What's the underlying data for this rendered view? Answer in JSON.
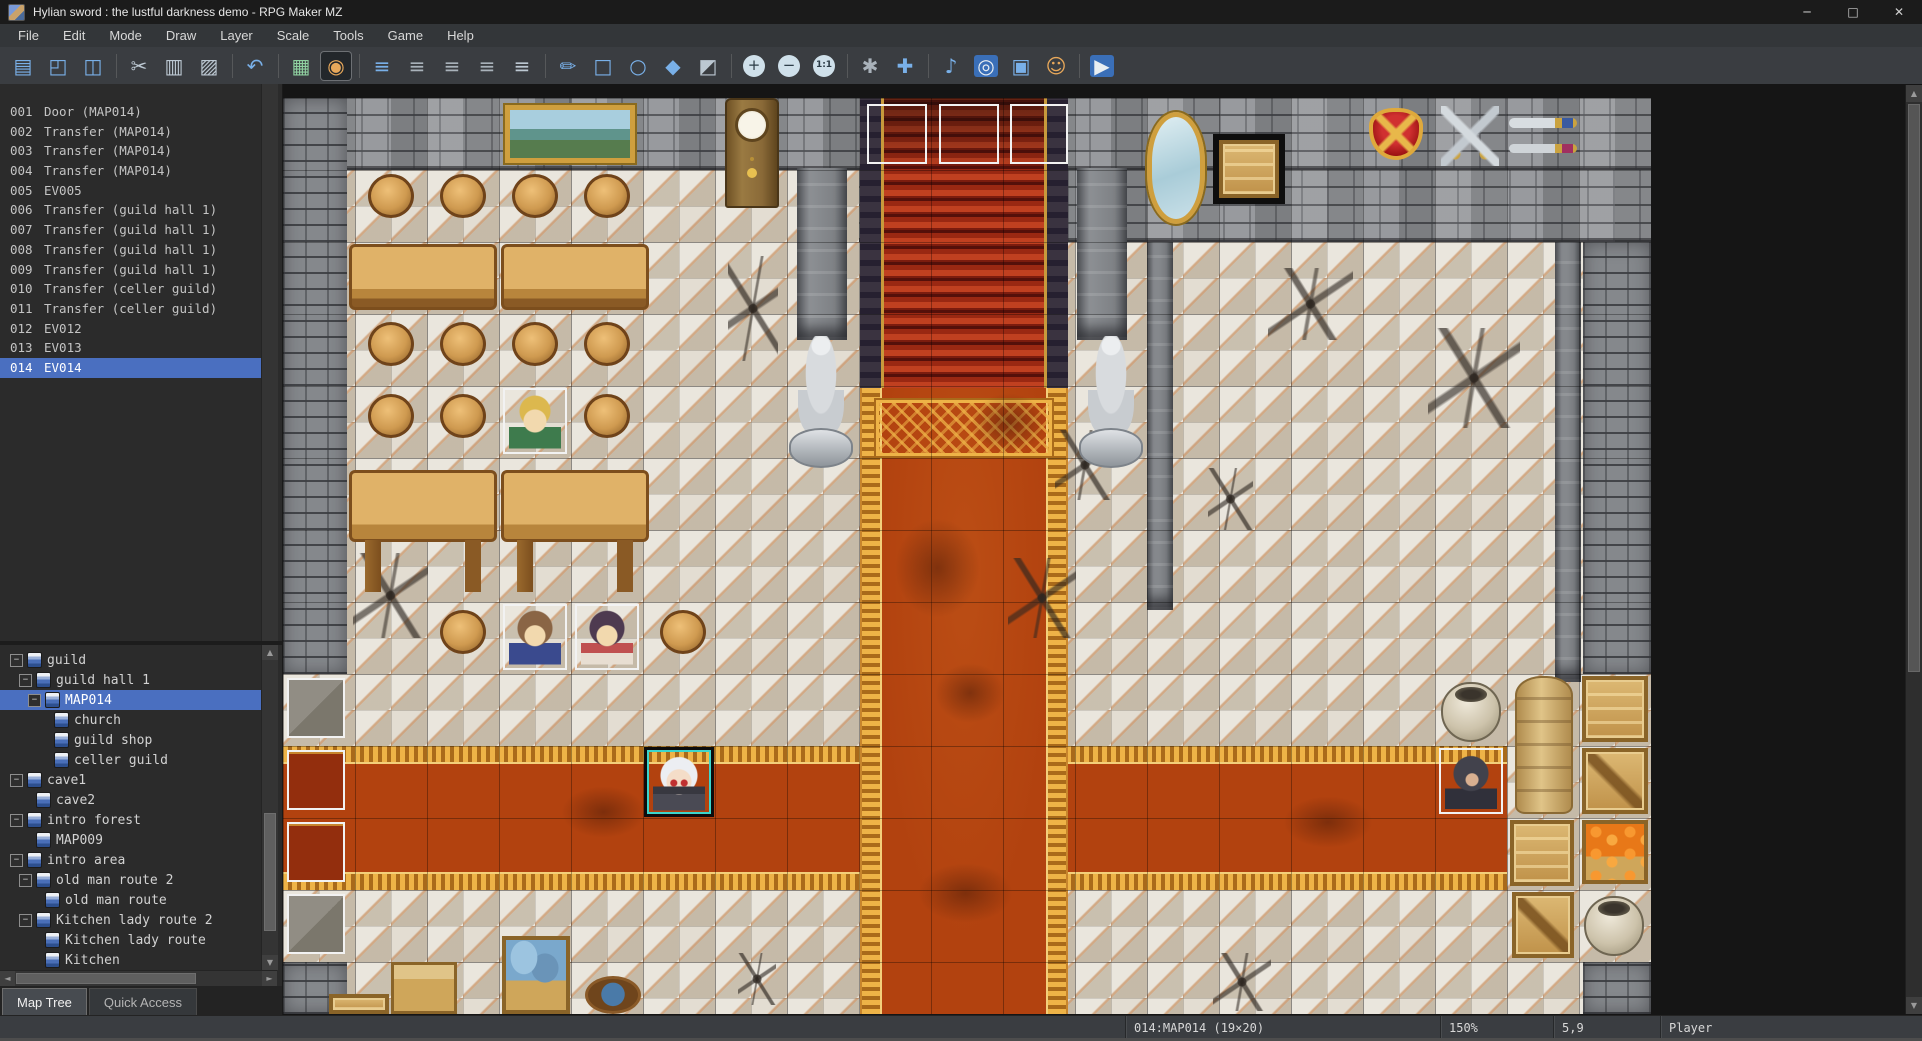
{
  "window": {
    "title": "Hylian sword : the lustful darkness demo - RPG Maker MZ",
    "controls": {
      "minimize": "─",
      "maximize": "□",
      "close": "✕"
    }
  },
  "menu_bar": {
    "items": [
      "File",
      "Edit",
      "Mode",
      "Draw",
      "Layer",
      "Scale",
      "Tools",
      "Game",
      "Help"
    ]
  },
  "toolbar": {
    "items": [
      {
        "name": "new-project",
        "glyph": "▤",
        "cls": "tintBlue"
      },
      {
        "name": "open-project",
        "glyph": "◰",
        "cls": "tintBlue"
      },
      {
        "name": "save-project",
        "glyph": "◫",
        "cls": "tintBlue"
      },
      {
        "s": 1
      },
      {
        "name": "cut",
        "glyph": "✂",
        "cls": "tintSteel"
      },
      {
        "name": "copy",
        "glyph": "▥",
        "cls": "tintSteel"
      },
      {
        "name": "paste",
        "glyph": "▨",
        "cls": "tintSteel"
      },
      {
        "s": 1
      },
      {
        "name": "undo",
        "glyph": "↶",
        "cls": "tintBlue"
      },
      {
        "s": 1
      },
      {
        "name": "map-mode",
        "glyph": "▦",
        "cls": "tintGreen"
      },
      {
        "name": "event-mode",
        "glyph": "◉",
        "cls": "tintOrange",
        "selected": true
      },
      {
        "s": 1
      },
      {
        "name": "layer-auto",
        "glyph": "≡",
        "cls": "tintBlue"
      },
      {
        "name": "layer-1",
        "glyph": "≡",
        "cls": "tintGrey"
      },
      {
        "name": "layer-2",
        "glyph": "≡",
        "cls": "tintGrey"
      },
      {
        "name": "layer-3",
        "glyph": "≡",
        "cls": "tintGrey"
      },
      {
        "name": "layer-4",
        "glyph": "≡",
        "cls": "tintSteel"
      },
      {
        "s": 1
      },
      {
        "name": "pencil-tool",
        "glyph": "✏",
        "cls": "tintBlue"
      },
      {
        "name": "rectangle-tool",
        "glyph": "□",
        "cls": "tintBlue"
      },
      {
        "name": "ellipse-tool",
        "glyph": "○",
        "cls": "tintBlue"
      },
      {
        "name": "flood-fill-tool",
        "glyph": "◆",
        "cls": "tintBlue"
      },
      {
        "name": "shadow-pen-tool",
        "glyph": "◩",
        "cls": "tintSteel"
      },
      {
        "s": 1
      },
      {
        "name": "zoom-in",
        "glyph": "+",
        "cls": "zoomchip"
      },
      {
        "name": "zoom-out",
        "glyph": "−",
        "cls": "zoomchip"
      },
      {
        "name": "zoom-actual",
        "glyph": "1:1",
        "cls": "zoomchip small"
      },
      {
        "s": 1
      },
      {
        "name": "database",
        "glyph": "✱",
        "cls": "tintGrey"
      },
      {
        "name": "plugin-manager",
        "glyph": "✚",
        "cls": "tintBlue"
      },
      {
        "s": 1
      },
      {
        "name": "sound-test",
        "glyph": "♪",
        "cls": "tintBlue"
      },
      {
        "name": "event-searcher",
        "glyph": "◎",
        "cls": "chipBlue tintWhite"
      },
      {
        "name": "resource-manager",
        "glyph": "▣",
        "cls": "tintBlue"
      },
      {
        "name": "character-generator",
        "glyph": "☺",
        "cls": "tintOrange"
      },
      {
        "s": 1
      },
      {
        "name": "playtest",
        "glyph": "▶",
        "cls": "chipBlue tintWhite"
      }
    ]
  },
  "event_list": {
    "selected": "014",
    "items": [
      {
        "num": "001",
        "label": "Door (MAP014)"
      },
      {
        "num": "002",
        "label": "Transfer (MAP014)"
      },
      {
        "num": "003",
        "label": "Transfer (MAP014)"
      },
      {
        "num": "004",
        "label": "Transfer (MAP014)"
      },
      {
        "num": "005",
        "label": "EV005"
      },
      {
        "num": "006",
        "label": "Transfer (guild hall 1)"
      },
      {
        "num": "007",
        "label": "Transfer (guild hall 1)"
      },
      {
        "num": "008",
        "label": "Transfer (guild hall 1)"
      },
      {
        "num": "009",
        "label": "Transfer (guild hall 1)"
      },
      {
        "num": "010",
        "label": "Transfer (celler guild)"
      },
      {
        "num": "011",
        "label": "Transfer (celler guild)"
      },
      {
        "num": "012",
        "label": "EV012"
      },
      {
        "num": "013",
        "label": "EV013"
      },
      {
        "num": "014",
        "label": "EV014"
      }
    ]
  },
  "map_tree": {
    "items": [
      {
        "label": "guild",
        "depth": 0,
        "exp": true
      },
      {
        "label": "guild hall 1",
        "depth": 1,
        "exp": true
      },
      {
        "label": "MAP014",
        "depth": 2,
        "exp": true,
        "selected": true
      },
      {
        "label": "church",
        "depth": 3,
        "exp": false
      },
      {
        "label": "guild shop",
        "depth": 3,
        "exp": false
      },
      {
        "label": "celler guild",
        "depth": 3,
        "exp": false
      },
      {
        "label": "cave1",
        "depth": 0,
        "exp": true
      },
      {
        "label": "cave2",
        "depth": 1,
        "exp": false
      },
      {
        "label": "intro forest",
        "depth": 0,
        "exp": true
      },
      {
        "label": "MAP009",
        "depth": 1,
        "exp": false
      },
      {
        "label": "intro area",
        "depth": 0,
        "exp": true
      },
      {
        "label": "old man route 2",
        "depth": 1,
        "exp": true
      },
      {
        "label": "old man route",
        "depth": 2,
        "exp": false
      },
      {
        "label": "Kitchen lady route 2",
        "depth": 1,
        "exp": true
      },
      {
        "label": "Kitchen lady route",
        "depth": 2,
        "exp": false
      },
      {
        "label": "Kitchen",
        "depth": 2,
        "exp": false
      }
    ],
    "tabs": [
      {
        "label": "Map Tree",
        "active": true
      },
      {
        "label": "Quick Access",
        "active": false
      }
    ]
  },
  "scroll_icons": {
    "up": "▲",
    "down": "▼",
    "left": "◄",
    "right": "►"
  },
  "status_bar": {
    "map_info": "014:MAP014 (19×20)",
    "zoom_level": "150%",
    "coords": "5,9",
    "mode": "Player"
  },
  "map_canvas": {
    "tile_px": 72,
    "cols": 19,
    "rows": 20,
    "zoom": "150%",
    "objects": [
      {
        "n": "floor",
        "t": "floor",
        "x": 0,
        "y": 0,
        "w": 1368,
        "h": 916
      },
      {
        "n": "horizontal-carpet",
        "t": "hcarpet",
        "x": 0,
        "y": 648,
        "w": 1224,
        "h": 144
      },
      {
        "n": "wall-top",
        "t": "wallA",
        "x": 0,
        "y": 0,
        "w": 1368,
        "h": 72
      },
      {
        "n": "wall-top-right",
        "t": "wallA",
        "x": 576,
        "y": 72,
        "w": 792,
        "h": 72
      },
      {
        "n": "west-wall",
        "t": "wallB",
        "x": 0,
        "y": 0,
        "w": 64,
        "h": 576
      },
      {
        "n": "west-wall-low",
        "t": "wallB",
        "x": 0,
        "y": 864,
        "w": 64,
        "h": 52
      },
      {
        "n": "east-wall",
        "t": "wallB",
        "x": 1300,
        "y": 144,
        "w": 68,
        "h": 432
      },
      {
        "n": "east-wall-low",
        "t": "wallB",
        "x": 1300,
        "y": 864,
        "w": 68,
        "h": 52
      },
      {
        "n": "pillar-left",
        "t": "pillar",
        "x": 514,
        "y": 70,
        "w": 50,
        "h": 172
      },
      {
        "n": "pillar-right",
        "t": "pillar",
        "x": 794,
        "y": 70,
        "w": 50,
        "h": 172
      },
      {
        "n": "pillar-mirror",
        "t": "pillar",
        "x": 864,
        "y": 144,
        "w": 26,
        "h": 368
      },
      {
        "n": "pillar-east",
        "t": "pillar",
        "x": 1272,
        "y": 144,
        "w": 26,
        "h": 440
      },
      {
        "n": "staircase",
        "t": "stairs",
        "x": 577,
        "y": 0,
        "w": 208,
        "h": 290
      },
      {
        "n": "vertical-carpet",
        "t": "vcarpet",
        "x": 577,
        "y": 290,
        "w": 208,
        "h": 626
      },
      {
        "n": "carpet-head",
        "t": "chead",
        "x": 593,
        "y": 302,
        "w": 176,
        "h": 56
      },
      {
        "n": "tile-grid",
        "t": "grid",
        "x": 0,
        "y": 0,
        "w": 1368,
        "h": 916
      },
      {
        "n": "floor-crack",
        "t": "crack",
        "x": 445,
        "y": 158,
        "w": 50,
        "h": 105
      },
      {
        "n": "floor-crack",
        "t": "crack",
        "x": 70,
        "y": 455,
        "w": 75,
        "h": 85
      },
      {
        "n": "floor-crack",
        "t": "crack",
        "x": 725,
        "y": 460,
        "w": 68,
        "h": 80
      },
      {
        "n": "floor-crack",
        "t": "crack",
        "x": 985,
        "y": 170,
        "w": 85,
        "h": 72
      },
      {
        "n": "floor-crack",
        "t": "crack",
        "x": 1145,
        "y": 230,
        "w": 92,
        "h": 100
      },
      {
        "n": "floor-crack",
        "t": "crack",
        "x": 925,
        "y": 370,
        "w": 45,
        "h": 62
      },
      {
        "n": "floor-crack",
        "t": "crack",
        "x": 772,
        "y": 332,
        "w": 60,
        "h": 70
      },
      {
        "n": "floor-crack",
        "t": "crack",
        "x": 930,
        "y": 855,
        "w": 58,
        "h": 58
      },
      {
        "n": "floor-crack",
        "t": "crack",
        "x": 455,
        "y": 855,
        "w": 38,
        "h": 52
      },
      {
        "n": "carpet-stain",
        "t": "smudge",
        "x": 688,
        "y": 295,
        "w": 75,
        "h": 60
      },
      {
        "n": "carpet-stain",
        "t": "smudge",
        "x": 612,
        "y": 420,
        "w": 85,
        "h": 100
      },
      {
        "n": "carpet-stain",
        "t": "smudge",
        "x": 652,
        "y": 565,
        "w": 70,
        "h": 60
      },
      {
        "n": "carpet-stain",
        "t": "smudge",
        "x": 635,
        "y": 765,
        "w": 95,
        "h": 60
      },
      {
        "n": "carpet-stain",
        "t": "smudge",
        "x": 278,
        "y": 688,
        "w": 85,
        "h": 52
      },
      {
        "n": "carpet-stain",
        "t": "smudge",
        "x": 1000,
        "y": 698,
        "w": 90,
        "h": 52
      },
      {
        "n": "wall-painting",
        "t": "painting",
        "x": 222,
        "y": 7,
        "w": 130,
        "h": 58
      },
      {
        "n": "grandfather-clock",
        "t": "clock",
        "x": 442,
        "y": 0,
        "w": 54,
        "h": 110
      },
      {
        "n": "wall-mirror",
        "t": "mirror",
        "x": 864,
        "y": 14,
        "w": 58,
        "h": 112
      },
      {
        "n": "crate-shadow",
        "t": "darksq",
        "x": 930,
        "y": 36,
        "w": 72,
        "h": 70
      },
      {
        "n": "wall-crate",
        "t": "crate",
        "x": 936,
        "y": 42,
        "w": 60,
        "h": 58
      },
      {
        "n": "wall-shield",
        "t": "shield",
        "x": 1086,
        "y": 10,
        "w": 54,
        "h": 52
      },
      {
        "n": "crossed-swords",
        "t": "xswords",
        "x": 1158,
        "y": 8,
        "w": 58,
        "h": 60
      },
      {
        "n": "sword-pair",
        "t": "swords2",
        "x": 1226,
        "y": 12,
        "w": 68,
        "h": 54
      },
      {
        "n": "statue-left",
        "t": "statue",
        "x": 504,
        "y": 238,
        "w": 68,
        "h": 132
      },
      {
        "n": "statue-right",
        "t": "statue",
        "x": 794,
        "y": 238,
        "w": 68,
        "h": 132
      },
      {
        "n": "long-table",
        "t": "table",
        "x": 66,
        "y": 146,
        "w": 148,
        "h": 66
      },
      {
        "n": "long-table",
        "t": "table",
        "x": 218,
        "y": 146,
        "w": 148,
        "h": 66
      },
      {
        "n": "long-table",
        "t": "tableTall",
        "x": 66,
        "y": 372,
        "w": 148,
        "h": 126
      },
      {
        "n": "long-table",
        "t": "tableTall",
        "x": 218,
        "y": 372,
        "w": 148,
        "h": 126
      },
      {
        "n": "stool",
        "t": "stool",
        "x": 85,
        "y": 76,
        "w": 46,
        "h": 44
      },
      {
        "n": "stool",
        "t": "stool",
        "x": 157,
        "y": 76,
        "w": 46,
        "h": 44
      },
      {
        "n": "stool",
        "t": "stool",
        "x": 229,
        "y": 76,
        "w": 46,
        "h": 44
      },
      {
        "n": "stool",
        "t": "stool",
        "x": 301,
        "y": 76,
        "w": 46,
        "h": 44
      },
      {
        "n": "stool",
        "t": "stool",
        "x": 85,
        "y": 224,
        "w": 46,
        "h": 44
      },
      {
        "n": "stool",
        "t": "stool",
        "x": 157,
        "y": 224,
        "w": 46,
        "h": 44
      },
      {
        "n": "stool",
        "t": "stool",
        "x": 229,
        "y": 224,
        "w": 46,
        "h": 44
      },
      {
        "n": "stool",
        "t": "stool",
        "x": 301,
        "y": 224,
        "w": 46,
        "h": 44
      },
      {
        "n": "stool",
        "t": "stool",
        "x": 85,
        "y": 296,
        "w": 46,
        "h": 44
      },
      {
        "n": "stool",
        "t": "stool",
        "x": 157,
        "y": 296,
        "w": 46,
        "h": 44
      },
      {
        "n": "stool",
        "t": "stool",
        "x": 301,
        "y": 296,
        "w": 46,
        "h": 44
      },
      {
        "n": "stool",
        "t": "stool",
        "x": 157,
        "y": 512,
        "w": 46,
        "h": 44
      },
      {
        "n": "stool",
        "t": "stool",
        "x": 377,
        "y": 512,
        "w": 46,
        "h": 44
      },
      {
        "n": "pot",
        "t": "pot",
        "x": 1158,
        "y": 584,
        "w": 60,
        "h": 60
      },
      {
        "n": "grain-sack",
        "t": "sack",
        "x": 1232,
        "y": 578,
        "w": 58,
        "h": 138
      },
      {
        "n": "crate",
        "t": "crate",
        "x": 1299,
        "y": 578,
        "w": 66,
        "h": 66
      },
      {
        "n": "crate",
        "t": "crateD",
        "x": 1299,
        "y": 650,
        "w": 66,
        "h": 66
      },
      {
        "n": "crate",
        "t": "crate",
        "x": 1227,
        "y": 722,
        "w": 64,
        "h": 66
      },
      {
        "n": "carrot-crate",
        "t": "carrot",
        "x": 1299,
        "y": 722,
        "w": 66,
        "h": 64
      },
      {
        "n": "crate",
        "t": "crateD",
        "x": 1229,
        "y": 794,
        "w": 62,
        "h": 66
      },
      {
        "n": "pot",
        "t": "pot",
        "x": 1301,
        "y": 798,
        "w": 60,
        "h": 60
      },
      {
        "n": "fish-crate",
        "t": "fishcrate",
        "x": 219,
        "y": 838,
        "w": 68,
        "h": 78
      },
      {
        "n": "wood-chest",
        "t": "chest",
        "x": 108,
        "y": 864,
        "w": 66,
        "h": 52
      },
      {
        "n": "small-crate",
        "t": "crate",
        "x": 46,
        "y": 896,
        "w": 60,
        "h": 20
      },
      {
        "n": "water-bucket",
        "t": "bucket",
        "x": 302,
        "y": 878,
        "w": 56,
        "h": 38
      },
      {
        "n": "event-box",
        "t": "ev",
        "x": 584,
        "y": 6,
        "w": 60,
        "h": 60,
        "i": true
      },
      {
        "n": "event-box",
        "t": "ev",
        "x": 656,
        "y": 6,
        "w": 60,
        "h": 60,
        "i": true
      },
      {
        "n": "event-box",
        "t": "ev",
        "x": 727,
        "y": 6,
        "w": 58,
        "h": 60,
        "i": true
      },
      {
        "n": "event-box",
        "t": "ev evGrey",
        "x": 4,
        "y": 580,
        "w": 58,
        "h": 60,
        "i": true
      },
      {
        "n": "event-box",
        "t": "ev evRed",
        "x": 4,
        "y": 652,
        "w": 58,
        "h": 60,
        "i": true
      },
      {
        "n": "event-box",
        "t": "ev evRed",
        "x": 4,
        "y": 724,
        "w": 58,
        "h": 60,
        "i": true
      },
      {
        "n": "event-box",
        "t": "ev evGrey",
        "x": 4,
        "y": 796,
        "w": 58,
        "h": 60,
        "i": true
      },
      {
        "n": "event-hero",
        "t": "ev",
        "x": 220,
        "y": 290,
        "w": 64,
        "h": 66,
        "i": true
      },
      {
        "n": "char-hero",
        "t": "charHero",
        "x": 226,
        "y": 292,
        "w": 52,
        "h": 62
      },
      {
        "n": "event-npc",
        "t": "ev",
        "x": 220,
        "y": 506,
        "w": 64,
        "h": 66,
        "i": true
      },
      {
        "n": "char-npc-brown",
        "t": "charBrown",
        "x": 226,
        "y": 508,
        "w": 52,
        "h": 62
      },
      {
        "n": "event-npc",
        "t": "ev",
        "x": 292,
        "y": 506,
        "w": 64,
        "h": 66,
        "i": true
      },
      {
        "n": "char-npc-dark",
        "t": "charDark",
        "x": 298,
        "y": 508,
        "w": 52,
        "h": 62
      },
      {
        "n": "event-selected",
        "t": "evSel",
        "x": 361,
        "y": 649,
        "w": 70,
        "h": 70,
        "i": true
      },
      {
        "n": "char-white-hair",
        "t": "charWhite",
        "x": 370,
        "y": 654,
        "w": 52,
        "h": 62
      },
      {
        "n": "event-hooded",
        "t": "ev",
        "x": 1156,
        "y": 650,
        "w": 64,
        "h": 66,
        "i": true
      },
      {
        "n": "char-hooded",
        "t": "charHood",
        "x": 1162,
        "y": 652,
        "w": 52,
        "h": 62
      }
    ]
  }
}
